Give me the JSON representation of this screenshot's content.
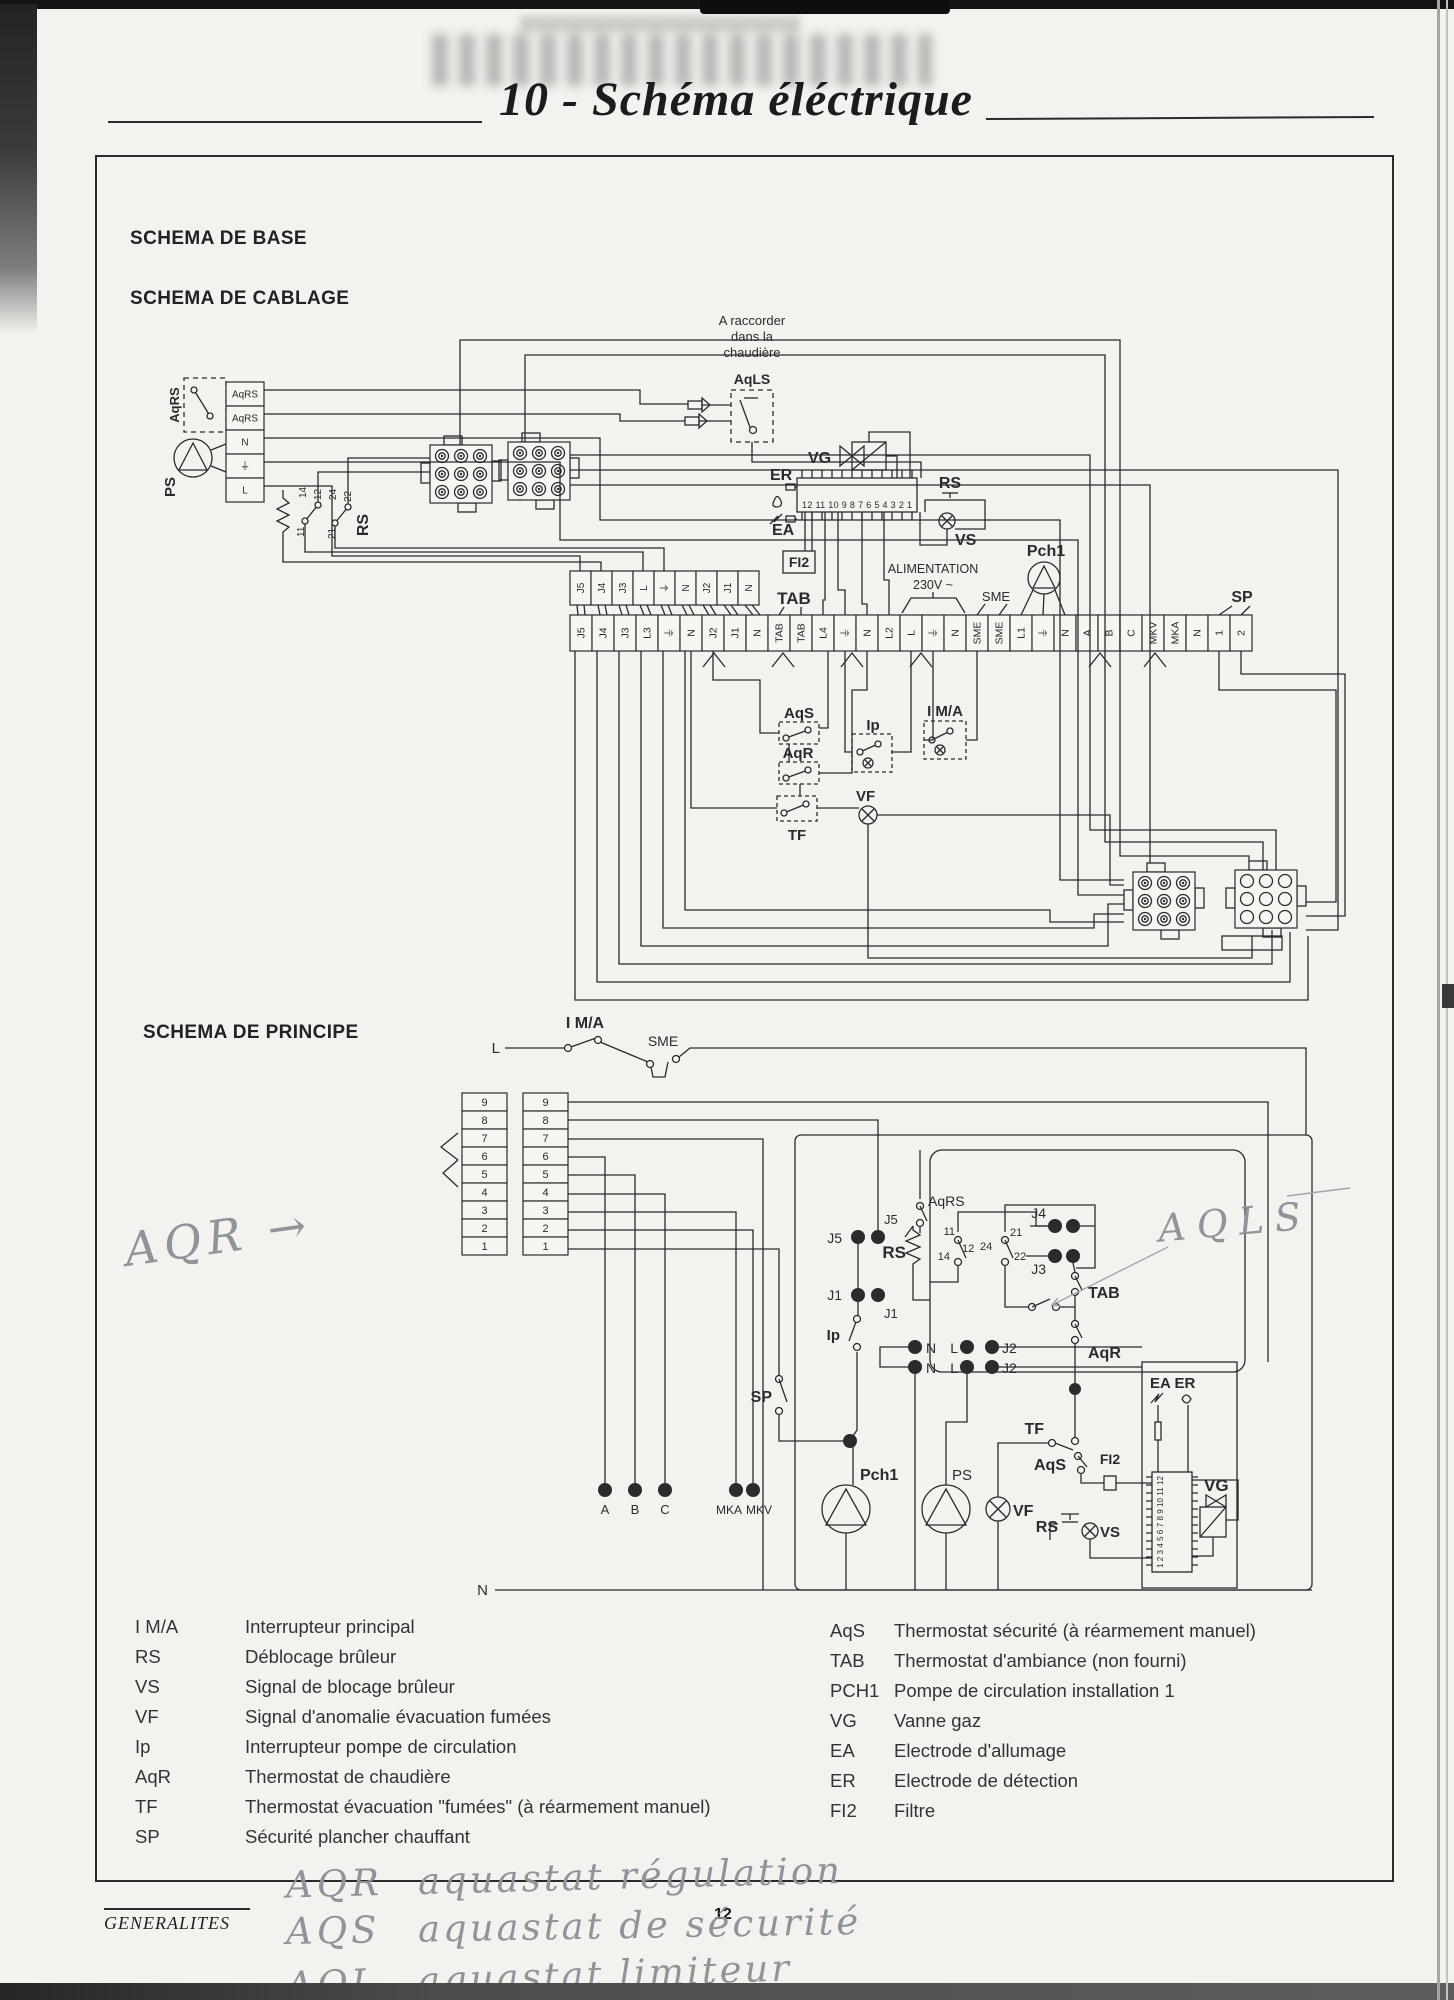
{
  "page": {
    "title": "10 - Schéma éléctrique",
    "footer_tab": "GENERALITES",
    "page_number": "12",
    "ink_color": "#2b2b2b",
    "pencil_color": "#8f939a",
    "paper_color": "#f3f2ee"
  },
  "headings": {
    "base": "SCHEMA DE BASE",
    "cablage": "SCHEMA DE CABLAGE",
    "principe": "SCHEMA DE PRINCIPE"
  },
  "cablage": {
    "note_lines": [
      "A raccorder",
      "dans la",
      "chaudière"
    ],
    "aqls": "AqLS",
    "aqrs": "AqRS",
    "ps": "PS",
    "rs": "RS",
    "rs_contacts": [
      "14",
      "12",
      "24",
      "22",
      "11",
      "21"
    ],
    "vg": "VG",
    "er": "ER",
    "ea": "EA",
    "rs2": "RS",
    "vs": "VS",
    "fi2": "FI2",
    "controller_pins": "12 11 10 9 8 7 6 5 4 3 2 1",
    "alimentation_1": "ALIMENTATION",
    "alimentation_2": "230V ~",
    "tab": "TAB",
    "sme": "SME",
    "pch1": "Pch1",
    "sp": "SP",
    "aqs": "AqS",
    "aqr": "AqR",
    "tf": "TF",
    "ip": "Ip",
    "ima": "I M/A",
    "vf": "VF",
    "left_terminals": [
      "AqRS",
      "AqRS",
      "N",
      "⏚",
      "L"
    ],
    "upper_strip": [
      "J5",
      "J4",
      "J3",
      "L",
      "⏚",
      "N",
      "J2",
      "J1",
      "N"
    ],
    "main_strip": [
      "J5",
      "J4",
      "J3",
      "L3",
      "⏚",
      "N",
      "J2",
      "J1",
      "N",
      "TAB",
      "TAB",
      "L4",
      "⏚",
      "N",
      "L2",
      "L",
      "⏚",
      "N",
      "SME",
      "SME",
      "L1",
      "⏚",
      "N",
      "A",
      "B",
      "C",
      "MKV",
      "MKA",
      "N",
      "1",
      "2"
    ]
  },
  "principe": {
    "l_line": "L",
    "n_line": "N",
    "ima": "I M/A",
    "sme": "SME",
    "j5": "J5",
    "j1": "J1",
    "j2": "J2",
    "j3": "J3",
    "j4": "J4",
    "n_label": "N",
    "l_label": "L",
    "rs": "RS",
    "aqrs": "AqRS",
    "contacts": [
      "11",
      "14",
      "12",
      "24",
      "21",
      "22"
    ],
    "tab": "TAB",
    "aqr": "AqR",
    "tf": "TF",
    "aqs": "AqS",
    "fi2": "FI2",
    "ip": "Ip",
    "sp": "SP",
    "pch1": "Pch1",
    "ps": "PS",
    "vf": "VF",
    "rs2": "RS",
    "vs": "VS",
    "ea_er": "EA ER",
    "vg": "VG",
    "controller_pins": "1 2 3 4 5 6 7 8 9 10 11 12",
    "left_block": [
      "9",
      "8",
      "7",
      "6",
      "5",
      "4",
      "3",
      "2",
      "1"
    ],
    "right_block": [
      "9",
      "8",
      "7",
      "6",
      "5",
      "4",
      "3",
      "2",
      "1"
    ],
    "bottom_terminals": [
      "A",
      "B",
      "C",
      "MKA",
      "MKV"
    ]
  },
  "legend": {
    "left": [
      {
        "sym": "I M/A",
        "desc": "Interrupteur principal"
      },
      {
        "sym": "RS",
        "desc": "Déblocage brûleur"
      },
      {
        "sym": "VS",
        "desc": "Signal de blocage brûleur"
      },
      {
        "sym": "VF",
        "desc": "Signal d'anomalie évacuation fumées"
      },
      {
        "sym": "Ip",
        "desc": "Interrupteur pompe de circulation"
      },
      {
        "sym": "AqR",
        "desc": "Thermostat de chaudière"
      },
      {
        "sym": "TF",
        "desc": "Thermostat évacuation \"fumées\" (à réarmement manuel)"
      },
      {
        "sym": "SP",
        "desc": "Sécurité plancher chauffant"
      }
    ],
    "right": [
      {
        "sym": "AqS",
        "desc": "Thermostat sécurité (à réarmement manuel)"
      },
      {
        "sym": "TAB",
        "desc": "Thermostat d'ambiance (non fourni)"
      },
      {
        "sym": "PCH1",
        "desc": "Pompe de circulation installation 1"
      },
      {
        "sym": "VG",
        "desc": "Vanne gaz"
      },
      {
        "sym": "EA",
        "desc": "Electrode d'allumage"
      },
      {
        "sym": "ER",
        "desc": "Electrode de détection"
      },
      {
        "sym": "FI2",
        "desc": "Filtre"
      }
    ]
  },
  "handwriting": {
    "aqr_margin": "AQR →",
    "aqls_note": "AQLS",
    "footer_lines": [
      {
        "abbr": "AQR",
        "text": "aquastat régulation"
      },
      {
        "abbr": "AQS",
        "text": "aquastat de sécurité"
      },
      {
        "abbr": "AQL",
        "text": "aquastat limiteur"
      }
    ]
  }
}
